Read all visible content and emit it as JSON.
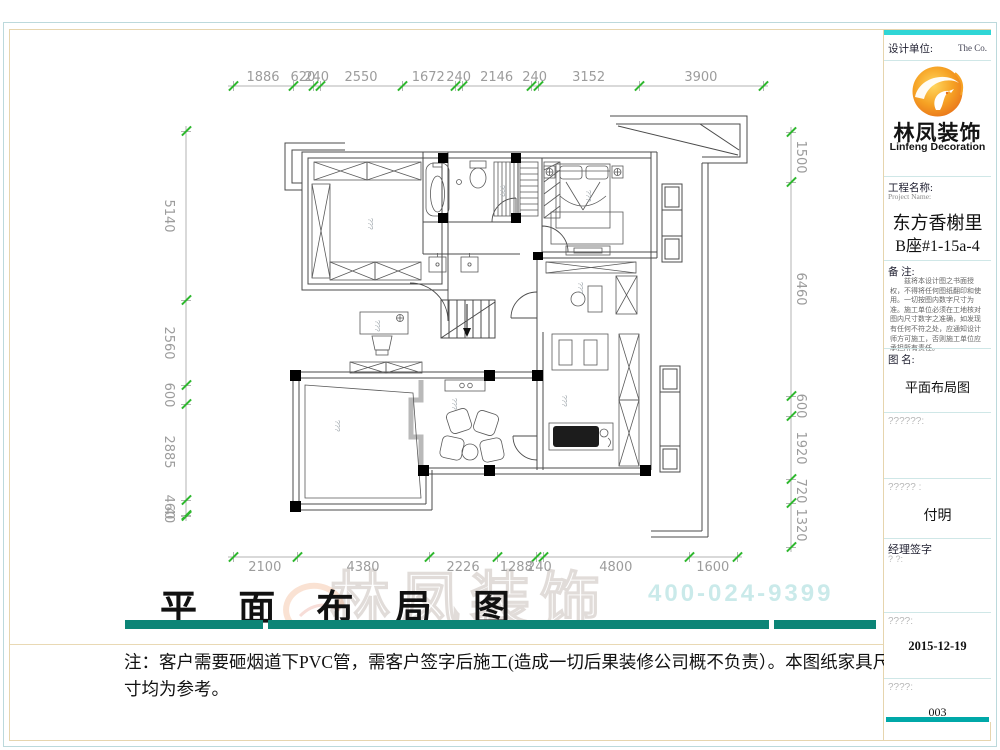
{
  "colors": {
    "accent_teal": "#0c8577",
    "titleblock_cyan": "#2fd6d6",
    "titleblock_teal": "#00a8a8",
    "tick_green": "#2eb82e",
    "dim_text_gray": "#9c9c9c",
    "logo_orange": "#f28a1e"
  },
  "dimensions": {
    "top": [
      "1886",
      "620",
      "240",
      "2550",
      "1672",
      "240",
      "2146",
      "240",
      "3152",
      "3900"
    ],
    "bottom": [
      "2100",
      "4380",
      "2226",
      "1288",
      "240",
      "4800",
      "1600"
    ],
    "left": [
      "5140",
      "2560",
      "600",
      "2885",
      "460",
      "40"
    ],
    "right": [
      "1500",
      "6460",
      "600",
      "1920",
      "720",
      "1320"
    ]
  },
  "plan": {
    "placeholder": "???"
  },
  "watermark": {
    "brand": "林凤装饰",
    "phone": "400-024-9399"
  },
  "footer": {
    "title": "平 面 布 局 图",
    "note": "注：客户需要砸烟道下PVC管，需客户签字后施工(造成一切后果装修公司概不负责）。本图纸家具尺寸均为参考。"
  },
  "title_block": {
    "design_unit_label": "设计单位:",
    "design_unit_right": "The  Co.",
    "logo_cn": "林凤装饰",
    "logo_en": "Linfeng Decoration",
    "project_label": "工程名称:",
    "project_label_en": "Project Name:",
    "project_name1": "东方香榭里",
    "project_name2": "B座#1-15a-4",
    "remark_label": "备  注:",
    "remark_text": "兹将本设计图之书面授权，不得将任何图纸翻印和使用。一切按图内数字尺寸为准。施工单位必须在工地核对图内尺寸数字之准确，如发现有任何不符之处，应通知设计师方可施工，否则施工单位应承担所有责任。",
    "drawing_name_label": "图  名:",
    "drawing_name": "平面布局图",
    "field1_label": "??????:",
    "field2_label": "????? :",
    "designer_name": "付明",
    "manager_label": "经理签字",
    "manager_sub": "?    ?:",
    "date_label": "????:",
    "date_value": "2015-12-19",
    "number_label": "????:",
    "number_value": "003"
  }
}
